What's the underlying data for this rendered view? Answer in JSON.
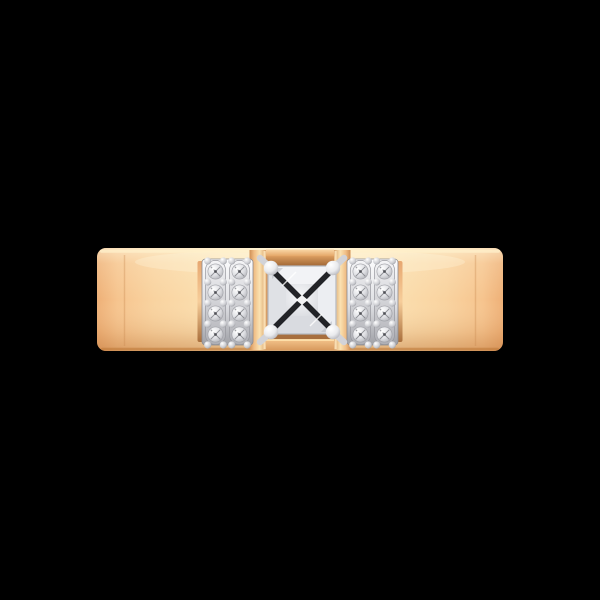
{
  "scene": {
    "background": "#000000"
  },
  "colors": {
    "band_edge": "#eeb077",
    "band_warm": "#f6c48e",
    "band_light": "#f9d3a0",
    "band_pale": "#fce3b5",
    "band_center": "#fdecc4",
    "top_highlight": "#fff0cb",
    "face_top_glow": "#fff8e0",
    "face_bottom_shade": "#b26426",
    "face_bottom_deep": "#a85c20",
    "bottom_edge_line": "#bf7a38",
    "seam": "#c98a50",
    "post_edge": "#cf8f55",
    "post_mid": "#f0bd85",
    "post_center": "#fae2b2",
    "post_highlight": "#ffe9c0",
    "bar_light": "#f9d6a6",
    "bar_mid": "#e3a363",
    "recess_mid": "#d99c5f",
    "recess_dark": "#9e6433",
    "bar_bottom_light": "#f3c38b",
    "bar_bottom_dark": "#d89a5e",
    "bar_bottom_glint": "#ffe3ae",
    "rim_top": "#e7a770",
    "rim_mid": "#f6cd9a",
    "rim_bottom": "#a96f3c",
    "plate_light": "#fcfcfd",
    "plate_mid": "#dddee2",
    "plate_dark": "#9fa0a6",
    "plate_stroke": "#8a8b91",
    "strip_light": "#f5f5f7",
    "strip_dark": "#aeafb5",
    "strip_stroke": "#96979d",
    "stone_core": "#ffffff",
    "stone_mid": "#dfe0e4",
    "stone_rim": "#aaabb1",
    "stone_stroke": "#9fa0a6",
    "pave_facet": "#6e6f75",
    "pave_culet": "#43444a",
    "pave_sparkle": "#ffffff",
    "bead_core": "#ffffff",
    "bead_mid": "#c9cacf",
    "bead_rim": "#808187",
    "prong_core": "#ffffff",
    "prong_mid": "#e9eaed",
    "prong_shade": "#b3b4ba",
    "prong_rim": "#84858b",
    "stem": "#d2d3d8",
    "diamond_base": "#e7e9ec",
    "diamond_outline": "#b4b7be",
    "facet_top": "#f2f3f6",
    "facet_bottom": "#d9dbe0",
    "facet_left": "#dfe1e5",
    "facet_right": "#eceef2",
    "table_light": "#f7f8fa",
    "table_dark": "#d5d7dc",
    "x_dark": "#17181c",
    "sparkle_white": "#ffffff",
    "sparkle_gray": "#b9bcc3",
    "shadow": "#000000"
  },
  "ring": {
    "band": {
      "style": "flat-wide-band",
      "metal": "rose-gold"
    },
    "center_stone": {
      "cut": "princess",
      "prong_count": 4
    },
    "side_stones": {
      "panel_count": 2,
      "columns_per_panel": 2,
      "stones_per_column": 4,
      "total_stones": 16
    }
  }
}
